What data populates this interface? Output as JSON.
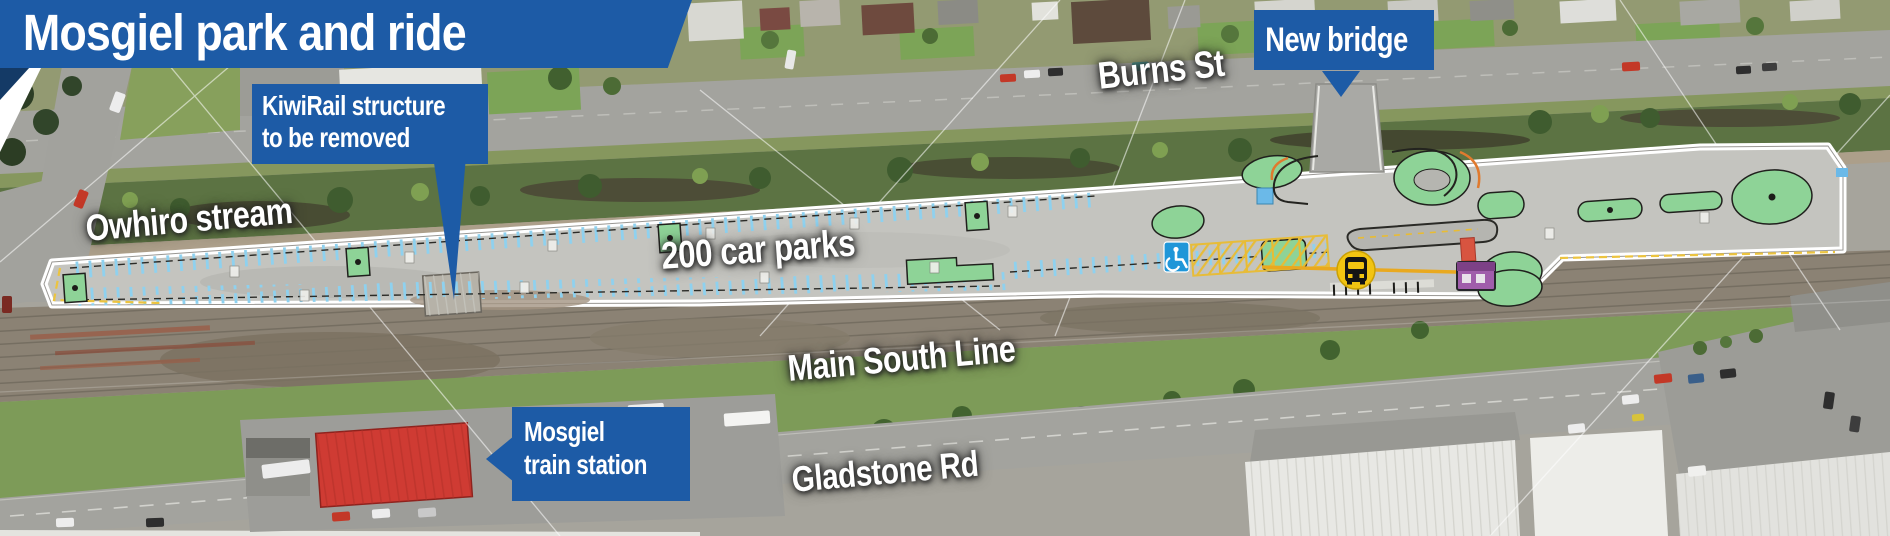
{
  "title": {
    "text": "Mosgiel park and ride"
  },
  "callouts": {
    "kiwirail": {
      "line1": "KiwiRail structure",
      "line2": "to be removed"
    },
    "new_bridge": {
      "text": "New bridge"
    },
    "train_station": {
      "line1": "Mosgiel",
      "line2": "train station"
    }
  },
  "map_labels": {
    "burns_st": "Burns St",
    "owhiro_stream": "Owhiro stream",
    "car_parks": "200 car parks",
    "main_south_line": "Main South Line",
    "gladstone_rd": "Gladstone Rd"
  },
  "icons": {
    "wheelchair": "accessible-parking-icon",
    "bus": "bus-stop-icon"
  },
  "colors": {
    "callout_blue": "#1d5ba6",
    "banner_fold_blue": "#143a66",
    "label_text": "#ffffff",
    "parking_bay_blue": "#8ed1ef",
    "landscaping_green": "#8ed397",
    "bus_circle_yellow": "#f2c411",
    "accessible_blue": "#1f96d8",
    "shelter_purple": "#a05dab",
    "station_roof_red": "#cf3b33",
    "site_asphalt": "#c4c4bf"
  }
}
